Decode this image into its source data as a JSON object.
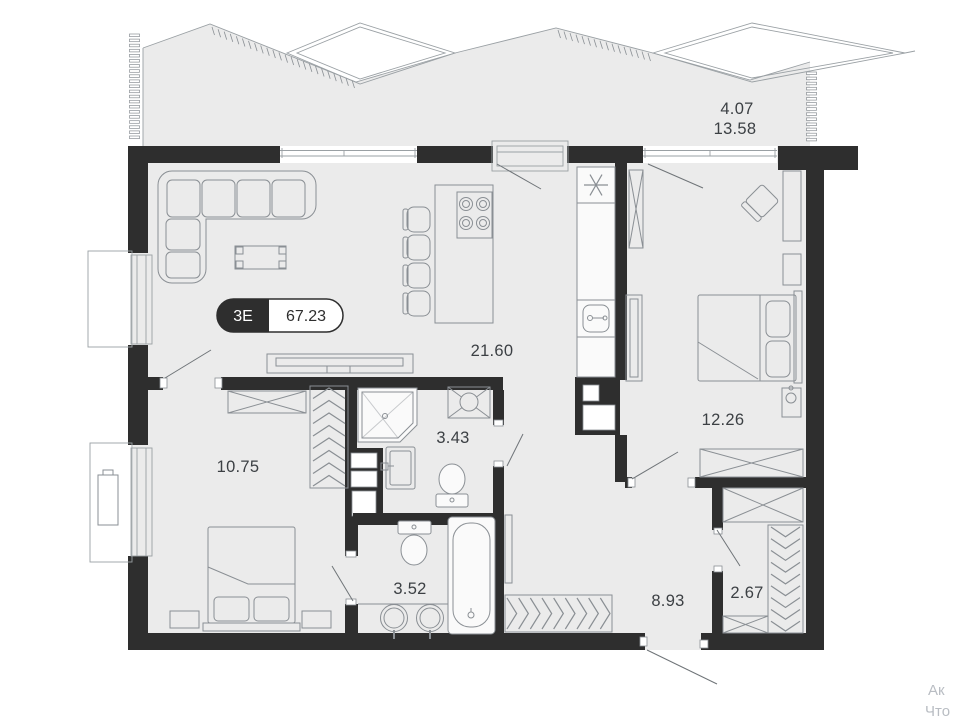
{
  "plan": {
    "badge": {
      "type_label": "3Е",
      "total_area": "67.23"
    },
    "labels": {
      "terrace_upper": "4.07",
      "terrace_lower": "13.58",
      "living_kitchen": "21.60",
      "bedroom_right": "12.26",
      "bedroom_left": "10.75",
      "bathroom_shower": "3.43",
      "bathroom_tub": "3.52",
      "hallway": "8.93",
      "closet": "2.67"
    },
    "rooms": [
      {
        "name": "terrace",
        "areas": [
          "4.07",
          "13.58"
        ]
      },
      {
        "name": "living-kitchen",
        "areas": [
          "21.60"
        ]
      },
      {
        "name": "bedroom-right",
        "areas": [
          "12.26"
        ]
      },
      {
        "name": "bedroom-left",
        "areas": [
          "10.75"
        ]
      },
      {
        "name": "bathroom-shower",
        "areas": [
          "3.43"
        ]
      },
      {
        "name": "bathroom-tub",
        "areas": [
          "3.52"
        ]
      },
      {
        "name": "hallway",
        "areas": [
          "8.93"
        ]
      },
      {
        "name": "closet",
        "areas": [
          "2.67"
        ]
      }
    ],
    "watermark": {
      "line1": "Ак",
      "line2": "Что"
    },
    "colors": {
      "wall": "#2e2e2e",
      "floor": "#ebebeb",
      "furniture_line": "#8a9094",
      "label_text": "#3c4044",
      "watermark_text": "#b9bdc3"
    }
  }
}
